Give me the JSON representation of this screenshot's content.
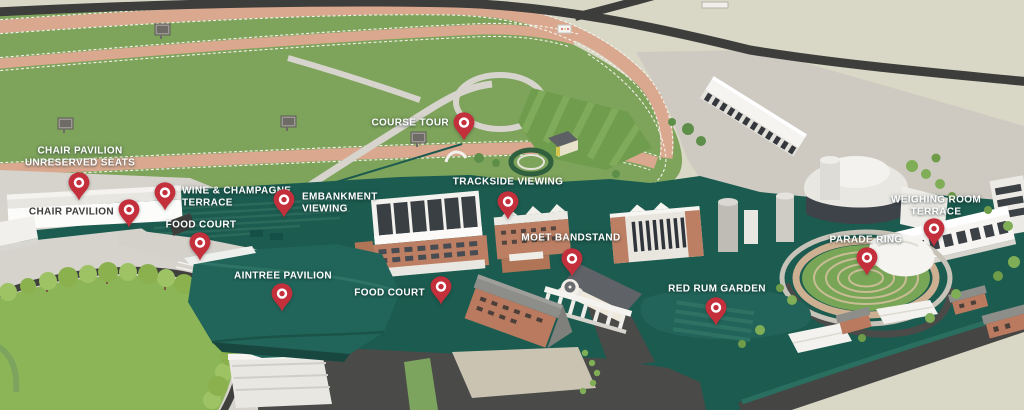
{
  "map": {
    "colors": {
      "pin": "#c42f3c",
      "pin_ring": "#ffffff",
      "concourse_green": "#1c5b4f",
      "course_grass": "#7ea35b",
      "track_tan": "#d9a88f",
      "background": "#d9d7c5",
      "road_dark": "#454543",
      "label_text": "#ffffff",
      "label_text_dark": "#3c3c3c"
    },
    "markers": [
      {
        "id": "course-tour",
        "lines": [
          "COURSE TOUR"
        ],
        "pin": {
          "x": 464,
          "y": 123
        },
        "label": {
          "x": 449,
          "y": 123,
          "align": "right",
          "dark": false
        }
      },
      {
        "id": "chair-pavilion-unreserved-seats",
        "lines": [
          "CHAIR PAVILION",
          "UNRESERVED SEATS"
        ],
        "pin": {
          "x": 79,
          "y": 183
        },
        "label": {
          "x": 80,
          "y": 157,
          "align": "center",
          "dark": false
        }
      },
      {
        "id": "chair-pavilion",
        "lines": [
          "CHAIR PAVILION"
        ],
        "pin": {
          "x": 129,
          "y": 210
        },
        "label": {
          "x": 114,
          "y": 212,
          "align": "right",
          "dark": true
        }
      },
      {
        "id": "wine-and-champagne-terrace",
        "lines": [
          "WINE & CHAMPAGNE",
          "TERRACE"
        ],
        "pin": {
          "x": 165,
          "y": 193
        },
        "label": {
          "x": 182,
          "y": 197,
          "align": "left",
          "dark": false
        }
      },
      {
        "id": "food-court-west",
        "lines": [
          "FOOD COURT"
        ],
        "pin": {
          "x": 200,
          "y": 243
        },
        "label": {
          "x": 201,
          "y": 225,
          "align": "center",
          "dark": false
        }
      },
      {
        "id": "embankment-viewing",
        "lines": [
          "EMBANKMENT",
          "VIEWING"
        ],
        "pin": {
          "x": 284,
          "y": 200
        },
        "label": {
          "x": 302,
          "y": 203,
          "align": "left",
          "dark": false
        }
      },
      {
        "id": "trackside-viewing",
        "lines": [
          "TRACKSIDE VIEWING"
        ],
        "pin": {
          "x": 508,
          "y": 202
        },
        "label": {
          "x": 508,
          "y": 182,
          "align": "center",
          "dark": false
        }
      },
      {
        "id": "aintree-pavilion",
        "lines": [
          "AINTREE PAVILION"
        ],
        "pin": {
          "x": 282,
          "y": 294
        },
        "label": {
          "x": 283,
          "y": 276,
          "align": "center",
          "dark": false
        }
      },
      {
        "id": "food-court-central",
        "lines": [
          "FOOD COURT"
        ],
        "pin": {
          "x": 441,
          "y": 287
        },
        "label": {
          "x": 425,
          "y": 293,
          "align": "right",
          "dark": false
        }
      },
      {
        "id": "moet-bandstand",
        "lines": [
          "MOET BANDSTAND"
        ],
        "pin": {
          "x": 572,
          "y": 259
        },
        "label": {
          "x": 571,
          "y": 238,
          "align": "center",
          "dark": false
        }
      },
      {
        "id": "red-rum-garden",
        "lines": [
          "RED RUM GARDEN"
        ],
        "pin": {
          "x": 716,
          "y": 308
        },
        "label": {
          "x": 717,
          "y": 289,
          "align": "center",
          "dark": false
        }
      },
      {
        "id": "parade-ring",
        "lines": [
          "PARADE RING"
        ],
        "pin": {
          "x": 867,
          "y": 258
        },
        "label": {
          "x": 866,
          "y": 240,
          "align": "center",
          "dark": false
        }
      },
      {
        "id": "weighing-room-terrace",
        "lines": [
          "WEIGHING ROOM",
          "TERRACE"
        ],
        "pin": {
          "x": 934,
          "y": 229
        },
        "label": {
          "x": 936,
          "y": 206,
          "align": "center",
          "dark": false
        }
      }
    ]
  }
}
